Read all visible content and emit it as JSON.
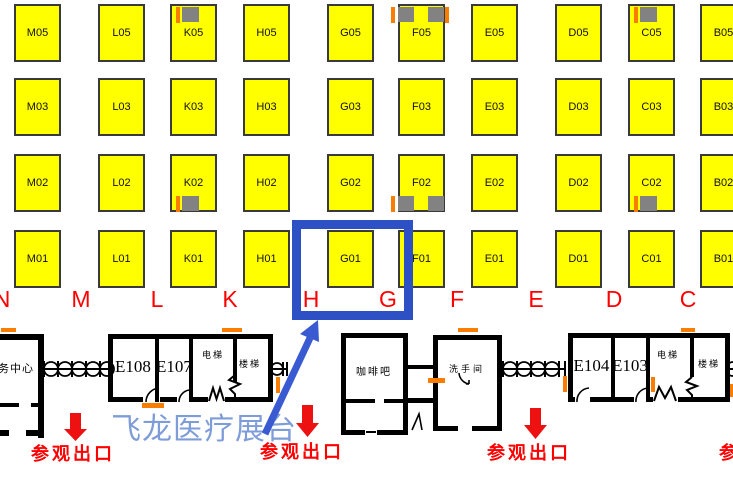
{
  "colors": {
    "booth_fill": "#FFFF00",
    "booth_border": "#3A3A3A",
    "letter_red": "#FF0000",
    "exit_red": "#EE1111",
    "highlight_blue": "#2E50C5",
    "arrow_blue": "#3A5AD2",
    "banner_blue": "#7E9CD8",
    "marker_orange": "#F97D00",
    "marker_gray": "#828282",
    "wall_black": "#000000"
  },
  "booths": {
    "labels": [
      "M05",
      "L05",
      "K05",
      "H05",
      "G05",
      "F05",
      "E05",
      "D05",
      "C05",
      "B05",
      "M03",
      "L03",
      "K03",
      "H03",
      "G03",
      "F03",
      "E03",
      "D03",
      "C03",
      "B03",
      "M02",
      "L02",
      "K02",
      "H02",
      "G02",
      "F02",
      "E02",
      "D02",
      "C02",
      "B02",
      "M01",
      "L01",
      "K01",
      "H01",
      "G01",
      "F01",
      "E01",
      "D01",
      "C01",
      "B01"
    ]
  },
  "column_letters": [
    "N",
    "M",
    "L",
    "K",
    "H",
    "G",
    "F",
    "E",
    "D",
    "C"
  ],
  "highlight": {
    "booth": "G01"
  },
  "banner": {
    "text": "飞龙医疗展台"
  },
  "exits": [
    "参观出口",
    "参观出口",
    "参观出口",
    "参观出口"
  ],
  "rooms": {
    "service_center": "务中心",
    "west": [
      "E108",
      "E107",
      "电梯",
      "楼梯"
    ],
    "cafe": "咖啡吧",
    "restroom": "洗手间",
    "east": [
      "E104",
      "E103",
      "电梯",
      "楼梯"
    ]
  },
  "markers": [
    {
      "booth": "K05",
      "edge": "top",
      "style": "single"
    },
    {
      "booth": "F05",
      "edge": "top",
      "style": "double_both"
    },
    {
      "booth": "C05",
      "edge": "top",
      "style": "single"
    },
    {
      "booth": "K02",
      "edge": "bottom",
      "style": "single"
    },
    {
      "booth": "F02",
      "edge": "bottom",
      "style": "double_left"
    },
    {
      "booth": "C02",
      "edge": "bottom",
      "style": "single"
    }
  ]
}
